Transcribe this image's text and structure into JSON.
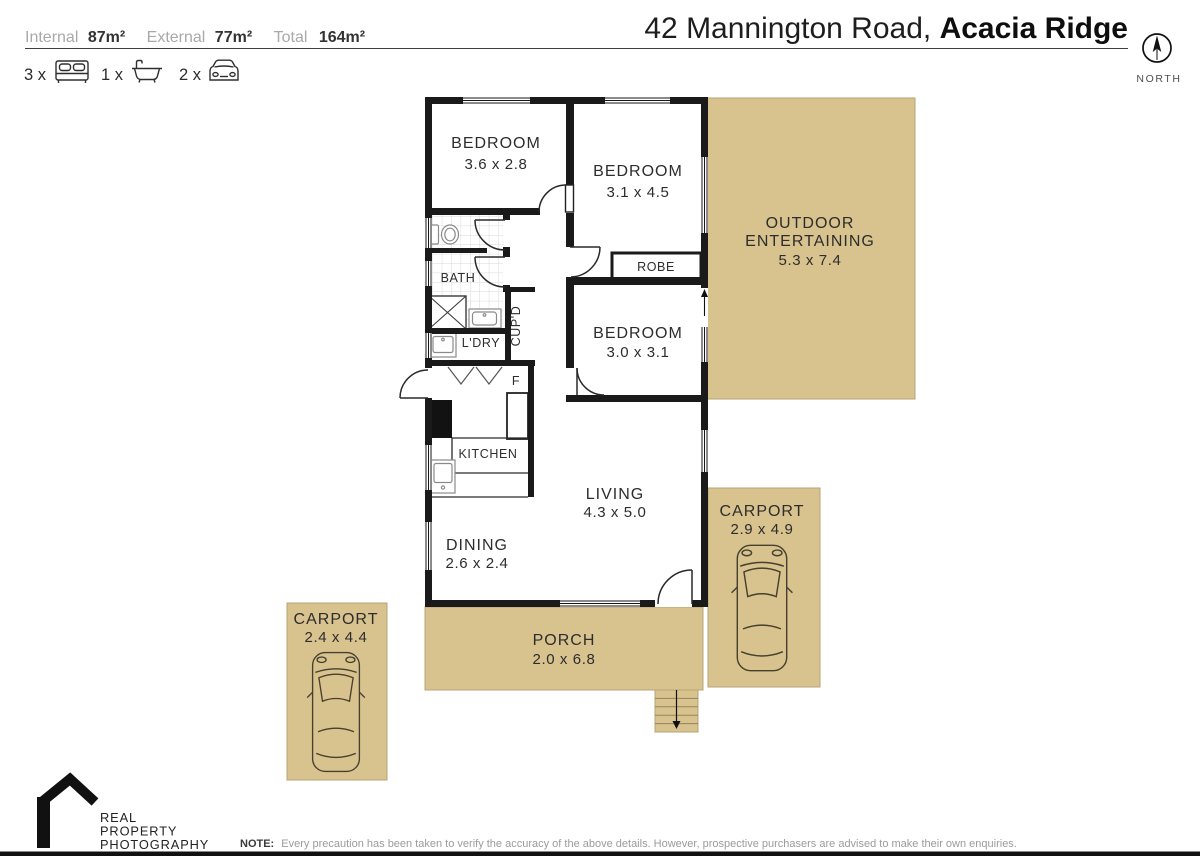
{
  "header": {
    "areas": [
      {
        "label": "Internal",
        "value": "87m²"
      },
      {
        "label": "External",
        "value": "77m²"
      },
      {
        "label": "Total",
        "value": "164m²"
      }
    ],
    "features": [
      {
        "count": "3 x",
        "icon": "bed-icon"
      },
      {
        "count": "1 x",
        "icon": "bath-icon"
      },
      {
        "count": "2 x",
        "icon": "car-icon"
      }
    ],
    "title": {
      "street": "42 Mannington Road, ",
      "suburb": "Acacia Ridge"
    },
    "compass": "NORTH"
  },
  "plan": {
    "rooms": [
      {
        "name": "BEDROOM",
        "dims": "3.6 x 2.8"
      },
      {
        "name": "BEDROOM",
        "dims": "3.1 x 4.5"
      },
      {
        "name": "BEDROOM",
        "dims": "3.0 x 3.1"
      },
      {
        "line1": "OUTDOOR",
        "line2": "ENTERTAINING",
        "dims": "5.3 x 7.4"
      },
      {
        "name": "LIVING",
        "dims": "4.3 x 5.0"
      },
      {
        "name": "DINING",
        "dims": "2.6 x 2.4"
      },
      {
        "name": "CARPORT",
        "dims": "2.9 x 4.9"
      },
      {
        "name": "CARPORT",
        "dims": "2.4 x 4.4"
      },
      {
        "name": "PORCH",
        "dims": "2.0 x 6.8"
      }
    ],
    "labels": {
      "bath": "BATH",
      "laundry": "L'DRY",
      "cupboard": "CUP'D",
      "fridge": "F",
      "kitchen": "KITCHEN",
      "robe": "ROBE"
    }
  },
  "footer": {
    "logo": [
      "REAL",
      "PROPERTY",
      "PHOTOGRAPHY"
    ],
    "note_label": "NOTE:",
    "note_text": "Every precaution has been taken to verify the accuracy of the above details. However, prospective purchasers are advised to make their own enquiries."
  },
  "colors": {
    "tan": "#d8c28e",
    "wall": "#1a1a1a"
  }
}
